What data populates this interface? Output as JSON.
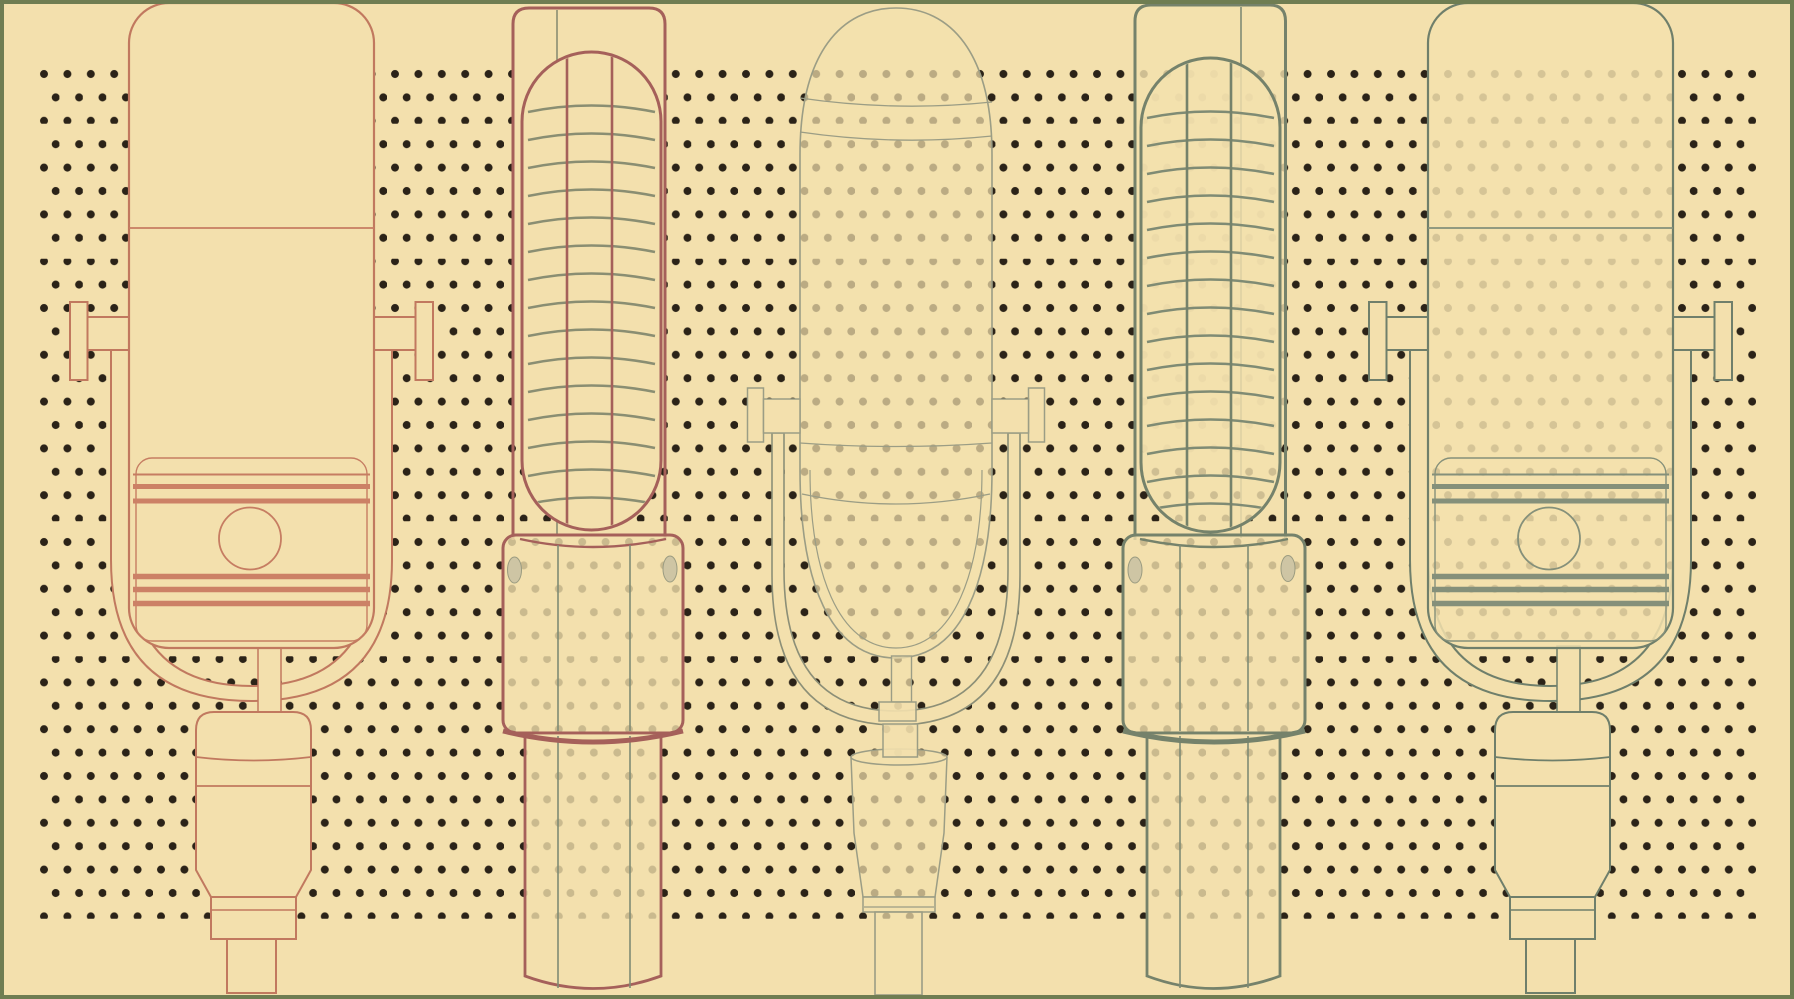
{
  "canvas": {
    "width": 1794,
    "height": 999,
    "background": "#F3E0AD",
    "border_color": "#6F7D52",
    "border_width": 4
  },
  "palette": {
    "cream": "#F3E0AD",
    "dot": "#2B2318",
    "border_green": "#6F7D52",
    "salmon": "#C1795F",
    "salmon_thin": "#C67D62",
    "salmon_accent": "#CC8166",
    "maroon": "#A5605A",
    "sage_arc": "#8A8E72",
    "sage_mid": "#7F8B74",
    "sage_dark": "#75826B",
    "sage5": "#6F7F6B",
    "sage5_accent": "#85907A",
    "gray3": "#9B9D85",
    "gray3_dark": "#8C8F77",
    "screw": "#CEC5A4",
    "screw_edge": "#9A9B80"
  },
  "dot_pattern": {
    "band": {
      "x": 36,
      "y": 62,
      "width": 1720,
      "height": 864
    },
    "spacing_x": 23.4,
    "spacing_y": 46.8,
    "dot_radius": 4,
    "color": "#2B2318",
    "split_line_ys": [
      125,
      257.5,
      390,
      522.5,
      655,
      787.5,
      920
    ],
    "split_line_width": 2.6
  },
  "clips": [
    {
      "id": "pill2",
      "x": 524,
      "y": 54,
      "w": 135,
      "h": 474,
      "rx": 67
    },
    {
      "id": "pill4",
      "x": 1143,
      "y": 60,
      "w": 135,
      "h": 470,
      "rx": 67
    }
  ],
  "microphones": [
    {
      "id": "microphone-1-studio-salmon",
      "stroke_key": "salmon",
      "shapes": [
        {
          "k": "rect",
          "x": 70,
          "y": 302,
          "w": 17.5,
          "h": 78,
          "f": "cream"
        },
        {
          "k": "rect",
          "x": 415.5,
          "y": 302,
          "w": 17.5,
          "h": 78,
          "f": "cream"
        },
        {
          "k": "rect",
          "x": 87.5,
          "y": 317,
          "w": 41.5,
          "h": 33,
          "f": "cream"
        },
        {
          "k": "rect",
          "x": 374,
          "y": 317,
          "w": 41.5,
          "h": 33,
          "f": "cream"
        },
        {
          "k": "path",
          "d": "M111,350 L111,560 Q111,701 251.5,701 Q392,701 392,560 L392,350 L374,350 L374,555 Q374,686 251.5,686 Q129,686 129,555 L129,350 Z",
          "f": "cream"
        },
        {
          "k": "rect",
          "x": 258,
          "y": 646,
          "w": 23,
          "h": 68,
          "f": "cream",
          "sw": 1.5
        },
        {
          "k": "path",
          "d": "M196,870 L196,730 Q196,712 214,712 L293,712 Q311,712 311,730 L311,870 L296,897 L211,897 Z",
          "f": "cream"
        },
        {
          "k": "path",
          "d": "M196,757 Q253.5,764 311,757",
          "sw": 1.8
        },
        {
          "k": "line",
          "x1": 196,
          "y1": 786,
          "x2": 311,
          "y2": 786,
          "sw": 1.8
        },
        {
          "k": "rect",
          "x": 211,
          "y": 897,
          "w": 85,
          "h": 42,
          "f": "cream"
        },
        {
          "k": "line",
          "x1": 211,
          "y1": 910,
          "x2": 296,
          "y2": 910,
          "sw": 1.5
        },
        {
          "k": "rect",
          "x": 227,
          "y": 939,
          "w": 49,
          "h": 54,
          "f": "cream"
        },
        {
          "k": "rect",
          "x": 129,
          "y": 3,
          "w": 245,
          "h": 645,
          "rx": 40,
          "f": "cream",
          "sw": 2.2
        },
        {
          "k": "line",
          "x1": 129,
          "y1": 228,
          "x2": 374,
          "y2": 228,
          "s": "salmon_thin",
          "sw": 1.8
        },
        {
          "k": "rect",
          "x": 136,
          "y": 458,
          "w": 231,
          "h": 183,
          "rx": 16,
          "s": "salmon_thin",
          "sw": 1.4
        },
        {
          "k": "line",
          "x1": 133,
          "y1": 474.5,
          "x2": 370,
          "y2": 474.5,
          "s": "salmon_thin",
          "sw": 2
        },
        {
          "k": "line",
          "x1": 133,
          "y1": 486.5,
          "x2": 370,
          "y2": 486.5,
          "s": "salmon_accent",
          "sw": 5
        },
        {
          "k": "line",
          "x1": 133,
          "y1": 501,
          "x2": 370,
          "y2": 501,
          "s": "salmon_accent",
          "sw": 5
        },
        {
          "k": "circle",
          "cx": 250,
          "cy": 538.5,
          "r": 31,
          "s": "salmon_thin",
          "sw": 1.8
        },
        {
          "k": "line",
          "x1": 133,
          "y1": 576.5,
          "x2": 370,
          "y2": 576.5,
          "s": "salmon_accent",
          "sw": 5.5
        },
        {
          "k": "line",
          "x1": 133,
          "y1": 589.5,
          "x2": 370,
          "y2": 589.5,
          "s": "salmon_accent",
          "sw": 5.5
        },
        {
          "k": "line",
          "x1": 133,
          "y1": 603.5,
          "x2": 370,
          "y2": 603.5,
          "s": "salmon_accent",
          "sw": 5.5
        }
      ]
    },
    {
      "id": "microphone-2-ribbon-maroon",
      "stroke_key": "maroon",
      "shapes": [
        {
          "k": "rect",
          "x": 514,
          "y": 9,
          "w": 150,
          "h": 446,
          "rx": 15,
          "f": "cream",
          "s": "none"
        },
        {
          "k": "path",
          "d": "M513,540 L513,24 Q513,8 529,8 L649,8 Q665,8 665,24 L665,540",
          "sw": 3
        },
        {
          "k": "line",
          "x1": 557,
          "y1": 10,
          "x2": 557,
          "y2": 534,
          "s": "sage_arc",
          "sw": 1.6
        },
        {
          "k": "rect",
          "x": 522,
          "y": 52,
          "w": 139,
          "h": 478,
          "rx": 69.5,
          "f": "cream",
          "sw": 3
        },
        {
          "k": "arcset",
          "x1": 528,
          "x2": 655,
          "bow": 13,
          "ys": [
            112,
            140,
            168,
            196,
            224,
            252,
            280,
            308,
            336,
            364,
            392,
            420,
            448,
            476,
            504
          ],
          "s": "sage_arc",
          "sw": 2.6,
          "clip": "pill2"
        },
        {
          "k": "line",
          "x1": 567,
          "y1": 57,
          "x2": 567,
          "y2": 524,
          "sw": 2.6,
          "clip": "pill2"
        },
        {
          "k": "line",
          "x1": 612,
          "y1": 55,
          "x2": 612,
          "y2": 526,
          "sw": 2.6,
          "clip": "pill2"
        },
        {
          "k": "rect",
          "x": 503,
          "y": 535,
          "w": 180,
          "h": 198,
          "rx": 13,
          "f": "cream",
          "fa": 0.8,
          "sw": 3
        },
        {
          "k": "path",
          "d": "M520,539 Q593,555 666,539",
          "sw": 2.4
        },
        {
          "k": "ellipse",
          "cx": 514.5,
          "cy": 570,
          "rx": 7,
          "ry": 13,
          "f": "screw",
          "s": "screw_edge",
          "sw": 1
        },
        {
          "k": "ellipse",
          "cx": 670,
          "cy": 569,
          "rx": 7,
          "ry": 13,
          "f": "screw",
          "s": "screw_edge",
          "sw": 1
        },
        {
          "k": "line",
          "x1": 558,
          "y1": 545,
          "x2": 558,
          "y2": 731,
          "s": "sage_mid",
          "sw": 1.6
        },
        {
          "k": "line",
          "x1": 630,
          "y1": 545,
          "x2": 630,
          "y2": 731,
          "s": "sage_mid",
          "sw": 1.6
        },
        {
          "k": "path",
          "d": "M525,733 L525,976 Q593,1001 661,976 L661,733 Z",
          "f": "cream",
          "fa": 0.8,
          "sw": 2.8
        },
        {
          "k": "line",
          "x1": 558,
          "y1": 736,
          "x2": 558,
          "y2": 988,
          "s": "sage_mid",
          "sw": 1.6
        },
        {
          "k": "line",
          "x1": 630,
          "y1": 736,
          "x2": 630,
          "y2": 988,
          "s": "sage_mid",
          "sw": 1.6
        },
        {
          "k": "path",
          "d": "M503,731 Q593,753 683,731",
          "sw": 5
        }
      ]
    },
    {
      "id": "microphone-3-capsule-gray",
      "stroke_key": "gray3",
      "shapes": [
        {
          "k": "path",
          "d": "M772,433 L772,575 Q772,725 896,725 Q1020,725 1020,575 L1020,433 L1008,433 L1008,570 Q1008,711 896,711 Q784,711 784,570 L784,433 Z",
          "f": "cream",
          "s": "gray3_dark",
          "sw": 1.6
        },
        {
          "k": "path",
          "d": "M851,757 L854,833 L863,897 L935,897 L944,833 L947,757",
          "f": "cream",
          "fa": 0.72,
          "sw": 1.5
        },
        {
          "k": "ellipse",
          "cx": 899,
          "cy": 757,
          "rx": 48,
          "ry": 8,
          "f": "cream",
          "fa": 0.72,
          "sw": 1.5
        },
        {
          "k": "rect",
          "x": 863,
          "y": 897,
          "w": 72,
          "h": 15,
          "f": "cream",
          "fa": 0.72,
          "sw": 1.5
        },
        {
          "k": "line",
          "x1": 864,
          "y1": 907,
          "x2": 934,
          "y2": 907,
          "sw": 1.3
        },
        {
          "k": "rect",
          "x": 875,
          "y": 912,
          "w": 47,
          "h": 83,
          "f": "cream",
          "fa": 0.72,
          "sw": 1.6
        },
        {
          "k": "path",
          "d": "M800,470 L800,155 C800,52 842,8 896,8 C950,8 992,52 992,155 L992,470 C992,582 962,658 896,658 C830,658 800,582 800,470 Z",
          "f": "cream",
          "fa": 0.72,
          "sw": 1.6
        },
        {
          "k": "path",
          "d": "M810,470 C810,572 838,648 896,648 C954,648 982,572 982,470",
          "sw": 1.2
        },
        {
          "k": "path",
          "d": "M800,98 Q896,112 992,102",
          "sw": 1.3
        },
        {
          "k": "path",
          "d": "M800,132 Q896,146 992,136",
          "sw": 1.3
        },
        {
          "k": "path",
          "d": "M800,443 Q896,450 992,443",
          "sw": 1.3
        },
        {
          "k": "path",
          "d": "M802,494 Q896,514 990,494",
          "sw": 1.3
        },
        {
          "k": "rect",
          "x": 747.5,
          "y": 388,
          "w": 16,
          "h": 54,
          "f": "cream",
          "sw": 1.5
        },
        {
          "k": "rect",
          "x": 1028.5,
          "y": 388,
          "w": 16,
          "h": 54,
          "f": "cream",
          "sw": 1.5
        },
        {
          "k": "rect",
          "x": 763.5,
          "y": 399,
          "w": 36.5,
          "h": 34,
          "f": "cream",
          "sw": 1.5
        },
        {
          "k": "rect",
          "x": 992,
          "y": 399,
          "w": 36.5,
          "h": 34,
          "f": "cream",
          "sw": 1.5
        },
        {
          "k": "rect",
          "x": 891.5,
          "y": 656,
          "w": 20,
          "h": 46,
          "f": "cream",
          "fa": 0.72,
          "sw": 1.4
        },
        {
          "k": "rect",
          "x": 879,
          "y": 702,
          "w": 37,
          "h": 19,
          "f": "cream",
          "fa": 0.9,
          "sw": 1.5
        },
        {
          "k": "rect",
          "x": 883,
          "y": 724,
          "w": 34.5,
          "h": 33,
          "f": "cream",
          "fa": 0.9,
          "sw": 1.5
        }
      ]
    },
    {
      "id": "microphone-4-ribbon-sage",
      "stroke_key": "sage_dark",
      "shapes": [
        {
          "k": "rect",
          "x": 1136,
          "y": 6,
          "w": 148.5,
          "h": 448,
          "rx": 15,
          "f": "cream",
          "fa": 0.82,
          "s": "none"
        },
        {
          "k": "path",
          "d": "M1135,540 L1135,21 Q1135,5 1151,5 L1269.5,5 Q1285.5,5 1285.5,21 L1285.5,540",
          "sw": 3
        },
        {
          "k": "line",
          "x1": 1241,
          "y1": 7,
          "x2": 1241,
          "y2": 538,
          "s": "sage_mid",
          "sw": 1.6
        },
        {
          "k": "rect",
          "x": 1141,
          "y": 58,
          "w": 139,
          "h": 474,
          "rx": 69.5,
          "f": "cream",
          "fa": 0.82,
          "sw": 3
        },
        {
          "k": "arcset",
          "x1": 1147,
          "x2": 1274,
          "bow": 13,
          "ys": [
            118,
            146,
            174,
            202,
            230,
            258,
            286,
            314,
            342,
            370,
            398,
            426,
            454,
            482,
            510
          ],
          "s": "sage_mid",
          "sw": 2.6,
          "clip": "pill4"
        },
        {
          "k": "line",
          "x1": 1187,
          "y1": 62,
          "x2": 1187,
          "y2": 528,
          "sw": 2.6,
          "clip": "pill4"
        },
        {
          "k": "line",
          "x1": 1231,
          "y1": 61,
          "x2": 1231,
          "y2": 529,
          "sw": 2.6,
          "clip": "pill4"
        },
        {
          "k": "rect",
          "x": 1123,
          "y": 535,
          "w": 182,
          "h": 198,
          "rx": 13,
          "f": "cream",
          "fa": 0.8,
          "sw": 3
        },
        {
          "k": "path",
          "d": "M1140,539 Q1214,555 1288,539",
          "sw": 2.4
        },
        {
          "k": "ellipse",
          "cx": 1135,
          "cy": 570,
          "rx": 7,
          "ry": 13,
          "f": "screw",
          "s": "screw_edge",
          "sw": 1
        },
        {
          "k": "ellipse",
          "cx": 1288,
          "cy": 568.5,
          "rx": 7,
          "ry": 13,
          "f": "screw",
          "s": "screw_edge",
          "sw": 1
        },
        {
          "k": "line",
          "x1": 1180,
          "y1": 545,
          "x2": 1180,
          "y2": 731,
          "s": "sage_mid",
          "sw": 1.6
        },
        {
          "k": "line",
          "x1": 1248,
          "y1": 545,
          "x2": 1248,
          "y2": 731,
          "s": "sage_mid",
          "sw": 1.6
        },
        {
          "k": "path",
          "d": "M1147,733 L1147,976 Q1213.5,1001 1280,976 L1280,733 Z",
          "f": "cream",
          "fa": 0.8,
          "sw": 2.8
        },
        {
          "k": "line",
          "x1": 1180,
          "y1": 736,
          "x2": 1180,
          "y2": 988,
          "s": "sage_mid",
          "sw": 1.6
        },
        {
          "k": "line",
          "x1": 1248,
          "y1": 736,
          "x2": 1248,
          "y2": 988,
          "s": "sage_mid",
          "sw": 1.6
        },
        {
          "k": "path",
          "d": "M1123,731 Q1214,753 1305,731",
          "sw": 5
        }
      ]
    },
    {
      "id": "microphone-5-studio-sage",
      "stroke_key": "sage5",
      "shapes": [
        {
          "k": "rect",
          "x": 1369,
          "y": 302,
          "w": 17.5,
          "h": 78,
          "f": "cream"
        },
        {
          "k": "rect",
          "x": 1714.5,
          "y": 302,
          "w": 17.5,
          "h": 78,
          "f": "cream"
        },
        {
          "k": "rect",
          "x": 1386.5,
          "y": 317,
          "w": 41.5,
          "h": 33,
          "f": "cream"
        },
        {
          "k": "rect",
          "x": 1673,
          "y": 317,
          "w": 41.5,
          "h": 33,
          "f": "cream"
        },
        {
          "k": "path",
          "d": "M1410,350 L1410,560 Q1410,701 1550.5,701 Q1691,701 1691,560 L1691,350 L1673,350 L1673,555 Q1673,686 1550.5,686 Q1428,686 1428,555 L1428,350 Z",
          "f": "cream"
        },
        {
          "k": "rect",
          "x": 1557,
          "y": 646,
          "w": 23,
          "h": 68,
          "f": "cream",
          "sw": 1.5
        },
        {
          "k": "path",
          "d": "M1495,870 L1495,730 Q1495,712 1513,712 L1592,712 Q1610,712 1610,730 L1610,870 L1595,897 L1510,897 Z",
          "f": "cream"
        },
        {
          "k": "path",
          "d": "M1495,757 Q1552.5,764 1610,757",
          "sw": 1.8
        },
        {
          "k": "line",
          "x1": 1495,
          "y1": 786,
          "x2": 1610,
          "y2": 786,
          "sw": 1.8
        },
        {
          "k": "rect",
          "x": 1510,
          "y": 897,
          "w": 85,
          "h": 42,
          "f": "cream"
        },
        {
          "k": "line",
          "x1": 1510,
          "y1": 910,
          "x2": 1595,
          "y2": 910,
          "sw": 1.5
        },
        {
          "k": "rect",
          "x": 1526,
          "y": 939,
          "w": 49,
          "h": 54,
          "f": "cream"
        },
        {
          "k": "rect",
          "x": 1428,
          "y": 3,
          "w": 245,
          "h": 645,
          "rx": 40,
          "f": "cream",
          "fa": 0.85,
          "sw": 2.2
        },
        {
          "k": "line",
          "x1": 1428,
          "y1": 228,
          "x2": 1673,
          "y2": 228,
          "s": "sage5_accent",
          "sw": 1.8
        },
        {
          "k": "rect",
          "x": 1435,
          "y": 458,
          "w": 231,
          "h": 183,
          "rx": 16,
          "s": "sage5_accent",
          "sw": 1.4
        },
        {
          "k": "line",
          "x1": 1432,
          "y1": 474.5,
          "x2": 1669,
          "y2": 474.5,
          "s": "sage5_accent",
          "sw": 2
        },
        {
          "k": "line",
          "x1": 1432,
          "y1": 486.5,
          "x2": 1669,
          "y2": 486.5,
          "s": "sage5_accent",
          "sw": 5
        },
        {
          "k": "line",
          "x1": 1432,
          "y1": 501,
          "x2": 1669,
          "y2": 501,
          "s": "sage5_accent",
          "sw": 5
        },
        {
          "k": "circle",
          "cx": 1549,
          "cy": 538.5,
          "r": 31,
          "s": "sage5_accent",
          "sw": 1.8
        },
        {
          "k": "line",
          "x1": 1432,
          "y1": 576.5,
          "x2": 1669,
          "y2": 576.5,
          "s": "sage5_accent",
          "sw": 5.5
        },
        {
          "k": "line",
          "x1": 1432,
          "y1": 589.5,
          "x2": 1669,
          "y2": 589.5,
          "s": "sage5_accent",
          "sw": 5.5
        },
        {
          "k": "line",
          "x1": 1432,
          "y1": 603.5,
          "x2": 1669,
          "y2": 603.5,
          "s": "sage5_accent",
          "sw": 5.5
        }
      ]
    }
  ]
}
